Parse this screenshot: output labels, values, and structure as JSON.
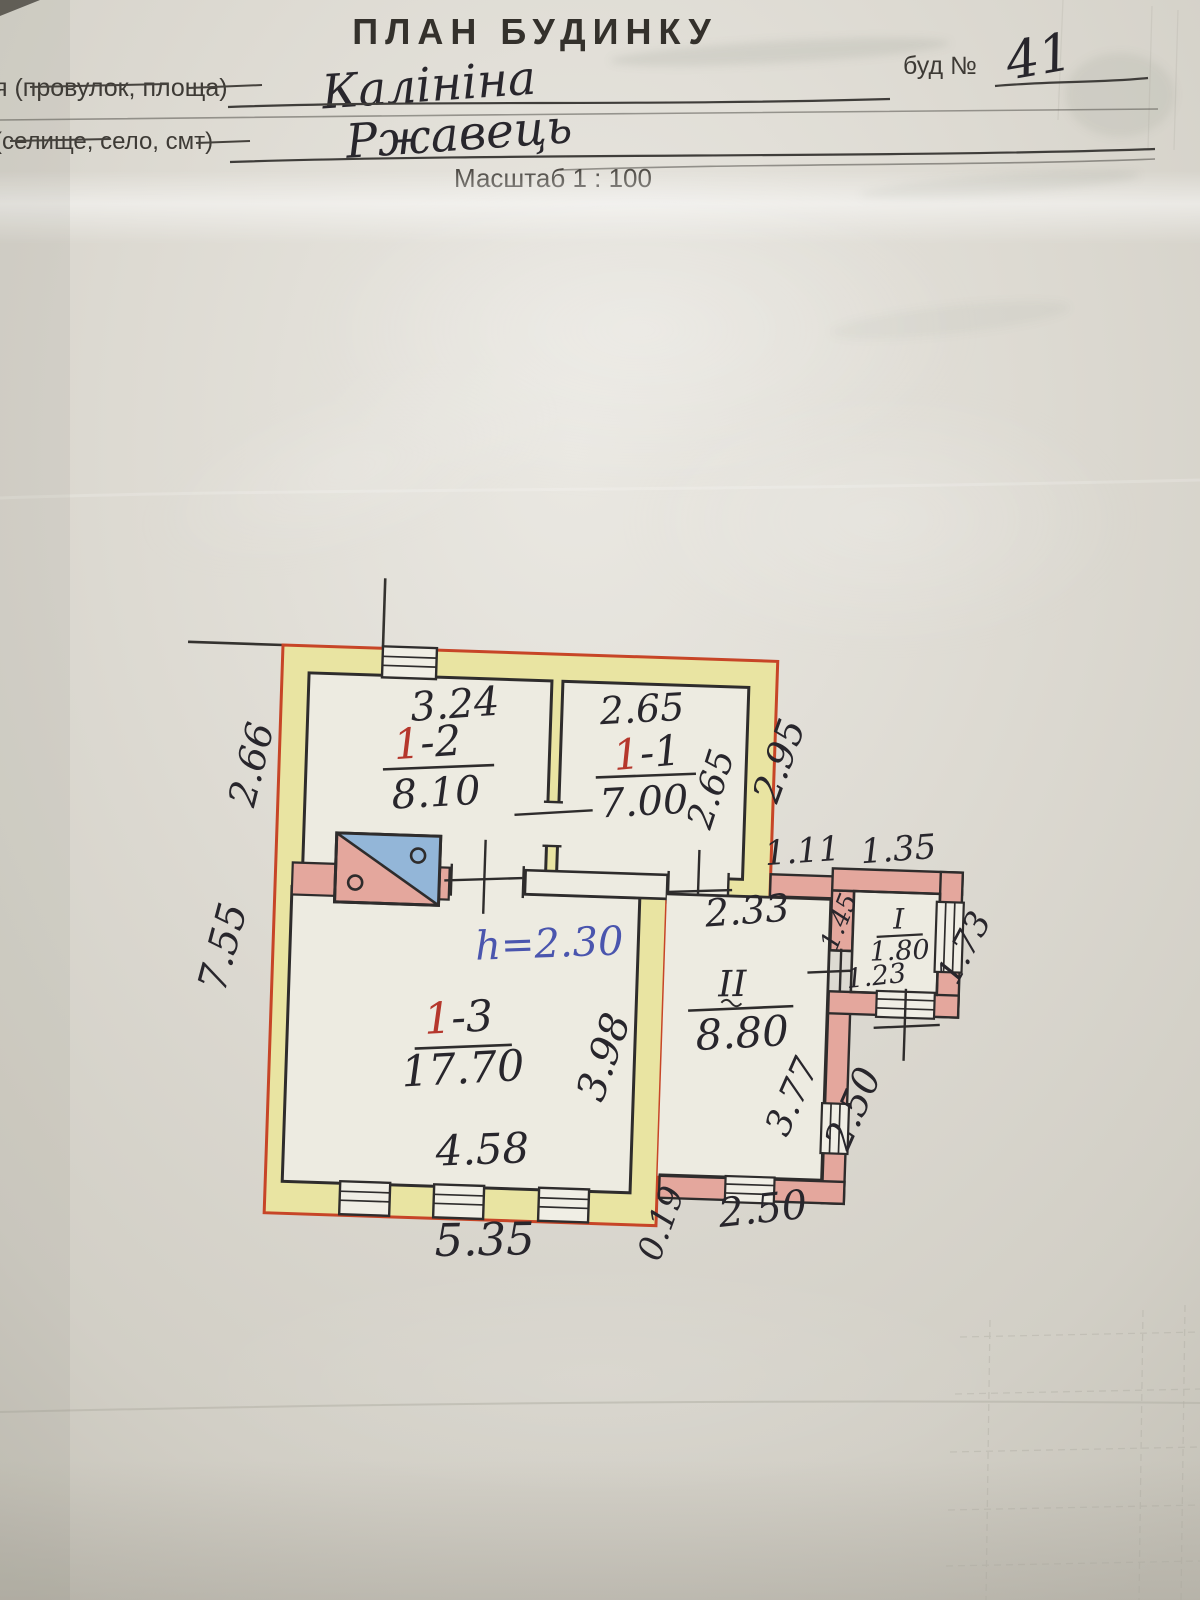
{
  "header": {
    "title": "ПЛАН БУДИНКУ",
    "street_label": "я (провулок, площа)",
    "street_value": "Калініна",
    "building_no_label": "буд №",
    "building_no_value": "41",
    "settlement_label": "(селище, село, смт)",
    "settlement_value": "Ржавець",
    "scale_label": "Масштаб 1 : 100"
  },
  "plan": {
    "height_note": "h=2.30",
    "dims": {
      "left_total": "7.55",
      "bottom_total": "5.35",
      "annex_top": "1.11"
    },
    "rooms": {
      "r12": {
        "num_red": "1",
        "num_rest": "-2",
        "area": "8.10",
        "width": "3.24",
        "depth": "2.66"
      },
      "r11": {
        "num_red": "1",
        "num_rest": "-1",
        "area": "7.00",
        "width": "2.65",
        "depth": "2.65",
        "outside_depth": "2.95"
      },
      "r13": {
        "num_red": "1",
        "num_rest": "-3",
        "area": "17.70",
        "width": "4.58",
        "depth": "3.98"
      },
      "rII": {
        "num": "II",
        "area": "8.80",
        "width": "2.33",
        "depth": "3.77",
        "out_right": "2.50",
        "out_bottom": "2.50",
        "offset": "0.19"
      },
      "rI": {
        "num": "I",
        "area": "1.80",
        "width": "1.23",
        "depth": "1.45",
        "out_right": "1.73",
        "out_top": "1.35"
      }
    }
  }
}
